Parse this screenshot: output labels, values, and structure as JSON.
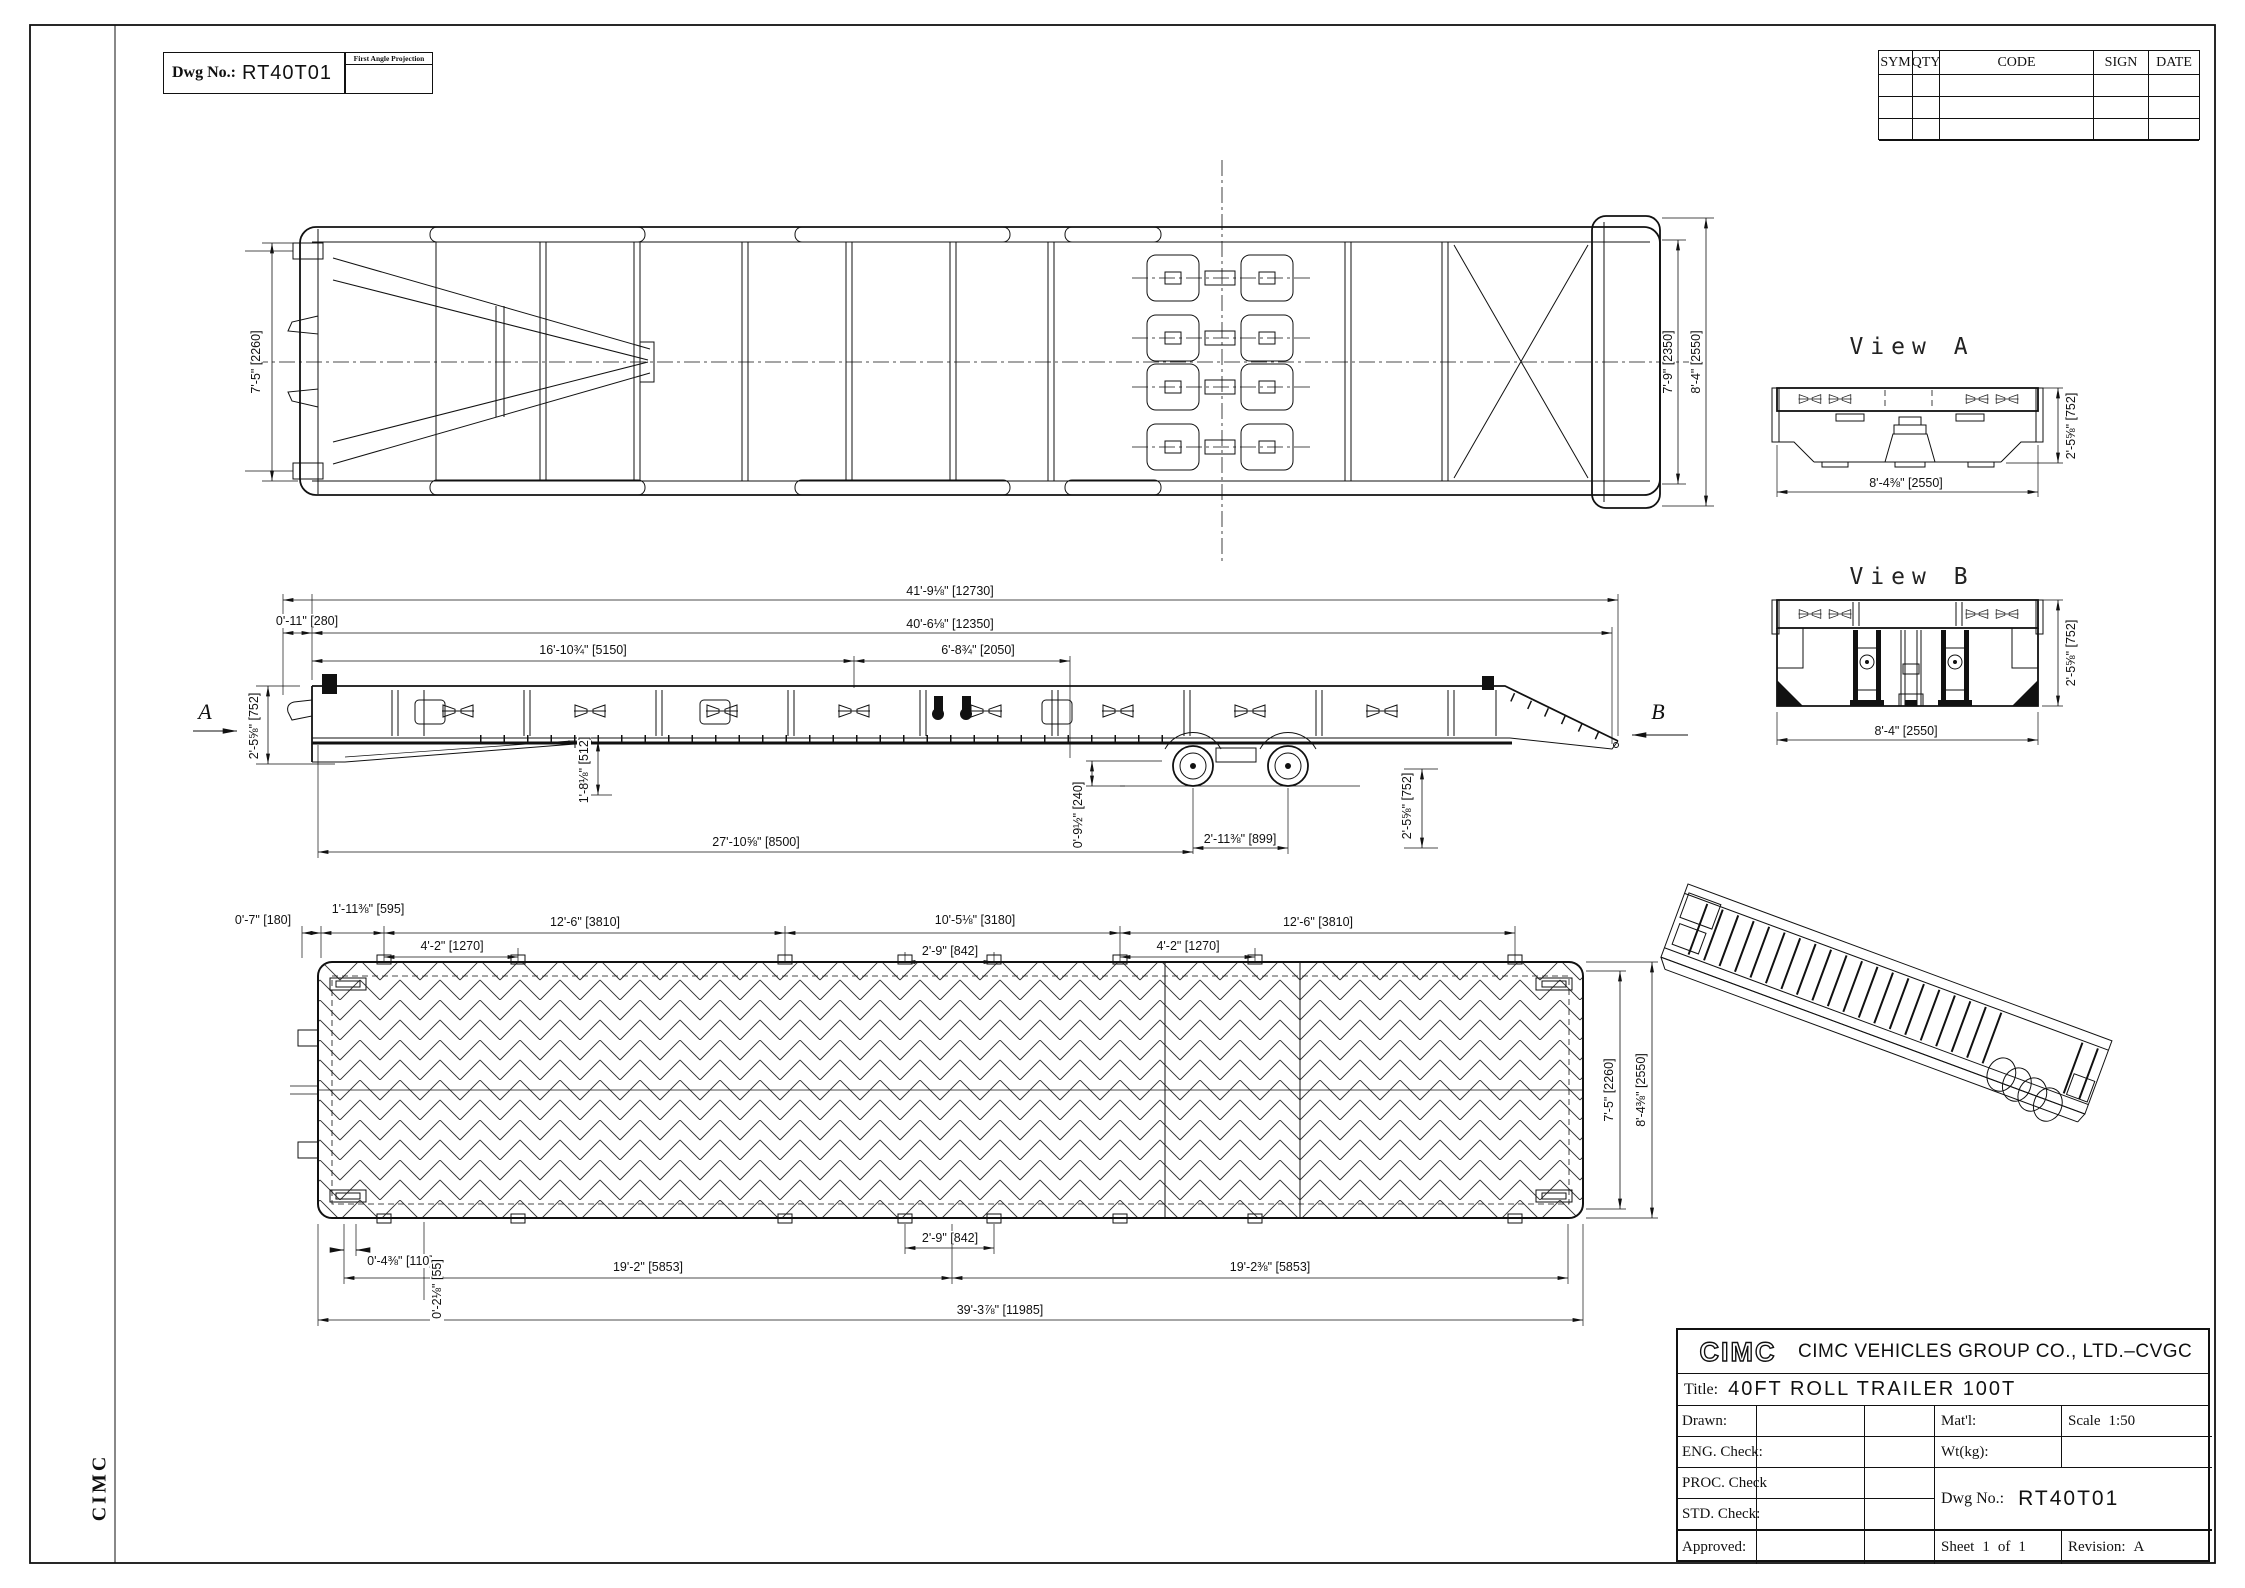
{
  "header": {
    "dwg_no_label": "Dwg No.:",
    "dwg_no": "RT40T01",
    "projection_label": "First Angle Projection"
  },
  "revision_table": {
    "col_sym": "SYM",
    "col_qty": "QTY",
    "col_code": "CODE",
    "col_sign": "SIGN",
    "col_date": "DATE"
  },
  "side_margin": {
    "brand": "CIMC"
  },
  "top_view": {
    "dim_width_inner": "7'-5\" [2260]",
    "dim_width_rear": "7'-9\" [2350]",
    "dim_width_overall": "8'-4\" [2550]"
  },
  "side_view": {
    "section_a": "A",
    "section_b": "B",
    "dim_total_length": "41'-9⅛\" [12730]",
    "dim_body_length": "40'-6⅛\" [12350]",
    "dim_front_overhang": "0'-11\" [280]",
    "dim_gooseneck": "16'-10¾\" [5150]",
    "dim_rear_section": "6'-8¾\" [2050]",
    "dim_front_height": "2'-5⅝\" [752]",
    "dim_neck_drop": "1'-8⅛\" [512]",
    "dim_wheelbase_front": "27'-10⅝\" [8500]",
    "dim_ground_clearance": "0'-9½\" [240]",
    "dim_axle_spacing": "2'-11⅜\" [899]",
    "dim_rear_height": "2'-5⅝\" [752]"
  },
  "deck_view": {
    "dim_front_edge": "0'-7\" [180]",
    "dim_first_cleat": "1'-11⅜\" [595]",
    "dim_bay_left": "12'-6\" [3810]",
    "dim_bay_center": "10'-5⅛\" [3180]",
    "dim_bay_right": "12'-6\" [3810]",
    "dim_cleat_pitch_left": "4'-2\" [1270]",
    "dim_cleat_center": "2'-9\" [842]",
    "dim_cleat_pitch_right": "4'-2\" [1270]",
    "dim_edge_offset": "0'-4⅜\" [110]",
    "dim_side_offset": "0'-2⅛\" [55]",
    "dim_half_left": "19'-2\" [5853]",
    "dim_center_gap": "2'-9\" [842]",
    "dim_half_right": "19'-2⅜\" [5853]",
    "dim_deck_length": "39'-3⅞\" [11985]",
    "dim_deck_width": "7'-5\" [2260]",
    "dim_overall_width": "8'-4⅜\" [2550]"
  },
  "view_a": {
    "title": "View A",
    "dim_width": "8'-4⅜\" [2550]",
    "dim_height": "2'-5⅝\" [752]"
  },
  "view_b": {
    "title": "View B",
    "dim_width": "8'-4\" [2550]",
    "dim_height": "2'-5⅝\" [752]"
  },
  "title_block": {
    "logo": "CIMC",
    "company": "CIMC VEHICLES GROUP CO., LTD.–CVGC",
    "title_label": "Title:",
    "title": "40FT ROLL TRAILER 100T",
    "drawn_label": "Drawn:",
    "eng_check_label": "ENG. Check:",
    "proc_check_label": "PROC. Check",
    "std_check_label": "STD. Check:",
    "approved_label": "Approved:",
    "matl_label": "Mat'l:",
    "wt_label": "Wt(kg):",
    "scale_label": "Scale",
    "scale_value": "1:50",
    "dwg_no_label": "Dwg No.:",
    "dwg_no": "RT40T01",
    "sheet_label": "Sheet",
    "sheet_no": "1",
    "of_label": "of",
    "sheet_total": "1",
    "revision_label": "Revision:",
    "revision": "A"
  }
}
